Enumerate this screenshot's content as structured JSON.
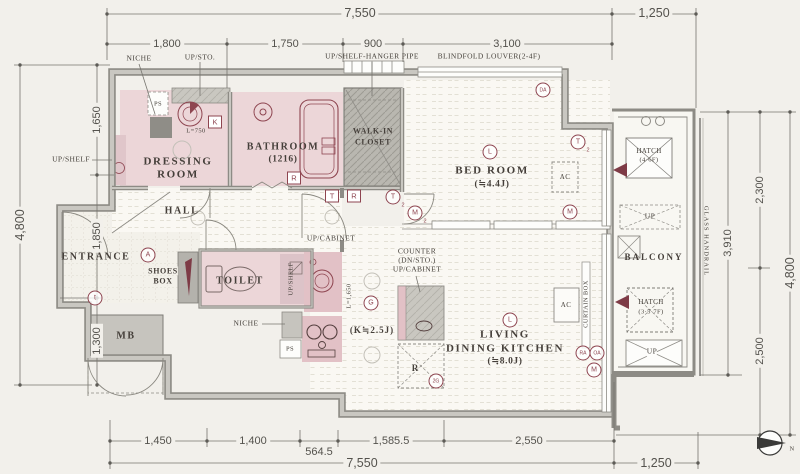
{
  "drawing": {
    "type": "apartment floor plan",
    "units": "mm"
  },
  "colors": {
    "background": "#f2f0eb",
    "wall": "#8d8b85",
    "room_pink": "#ecd6d8",
    "fixture_pink": "#e2c1c6",
    "closet_gray": "#c6c4be",
    "dark_gray": "#8f8d87",
    "accent_maroon": "#8e4550",
    "dim_text": "#54524d",
    "label_text": "#453f3a"
  },
  "dims": {
    "top_total": "7,550",
    "top_right": "1,250",
    "top_segs": [
      "1,800",
      "1,750",
      "900",
      "3,100"
    ],
    "left_total": "4,800",
    "left_segs": [
      "1,650",
      "1,850",
      "1,300"
    ],
    "right_inner": "3,910",
    "right_segs": [
      "2,300",
      "2,500"
    ],
    "right_total": "4,800",
    "bottom_segs": [
      "1,450",
      "1,400",
      "564.5",
      "1,585.5",
      "2,550"
    ],
    "bottom_total": "7,550",
    "bottom_right": "1,250"
  },
  "top_labels": {
    "niche": "NICHE",
    "up_sto": "UP/STO.",
    "hanger": "UP/SHELF-HANGER PIPE",
    "louver": "BLINDFOLD LOUVER(2-4F)"
  },
  "rooms": {
    "entrance": "ENTRANCE",
    "hall": "HALL",
    "dressing": {
      "l1": "DRESSING",
      "l2": "ROOM"
    },
    "bathroom": {
      "l1": "BATHROOM",
      "l2": "(1216)"
    },
    "wic": {
      "l1": "WALK-IN",
      "l2": "CLOSET"
    },
    "bedroom": {
      "l1": "BED ROOM",
      "l2": "(≒4.4J)"
    },
    "toilet": "TOILET",
    "shoes": {
      "l1": "SHOES",
      "l2": "BOX"
    },
    "mb": "MB",
    "ldk": {
      "l1": "LIVING",
      "l2": "DINING KITCHEN",
      "l3": "(≒8.0J)"
    },
    "kitchen": "(K≒2.5J)",
    "balcony": "BALCONY"
  },
  "features": {
    "hatch_upper": {
      "l1": "HATCH",
      "l2": "(4·6F)"
    },
    "hatch_lower": {
      "l1": "HATCH",
      "l2": "(3·5·7F)"
    },
    "up1": "UP",
    "up2": "UP",
    "up_shelf": "UP/SHELF",
    "up_shelf_toilet": "UP/SHELF",
    "up_cabinet": "UP/CABINET",
    "counter": {
      "l1": "COUNTER",
      "l2": "(DN/STO.)",
      "l3": "UP/CABINET"
    },
    "niche": "NICHE",
    "ps1": "PS",
    "ps2": "PS",
    "l750": "L=750",
    "l1650": "L=1,650",
    "ac1": "AC",
    "ac2": "AC",
    "glass_handrail": "GLASS HANDRAIL",
    "curtain_box": "CURTAIN BOX",
    "k_box": "K",
    "t_box": "T",
    "r_box": "R",
    "r_bath": "R",
    "r_dashed": "R",
    "north": "N"
  },
  "markers": [
    {
      "label": "A"
    },
    {
      "label": "t"
    },
    {
      "label": "G"
    },
    {
      "label": "L"
    },
    {
      "label": "L"
    },
    {
      "label": "DA"
    },
    {
      "label": "T",
      "sub": "2"
    },
    {
      "label": "M",
      "sub": "2"
    },
    {
      "label": "T",
      "sub": "2"
    },
    {
      "label": "M"
    },
    {
      "label": "RA"
    },
    {
      "label": "OA"
    },
    {
      "label": "M"
    },
    {
      "label": "2G"
    }
  ]
}
